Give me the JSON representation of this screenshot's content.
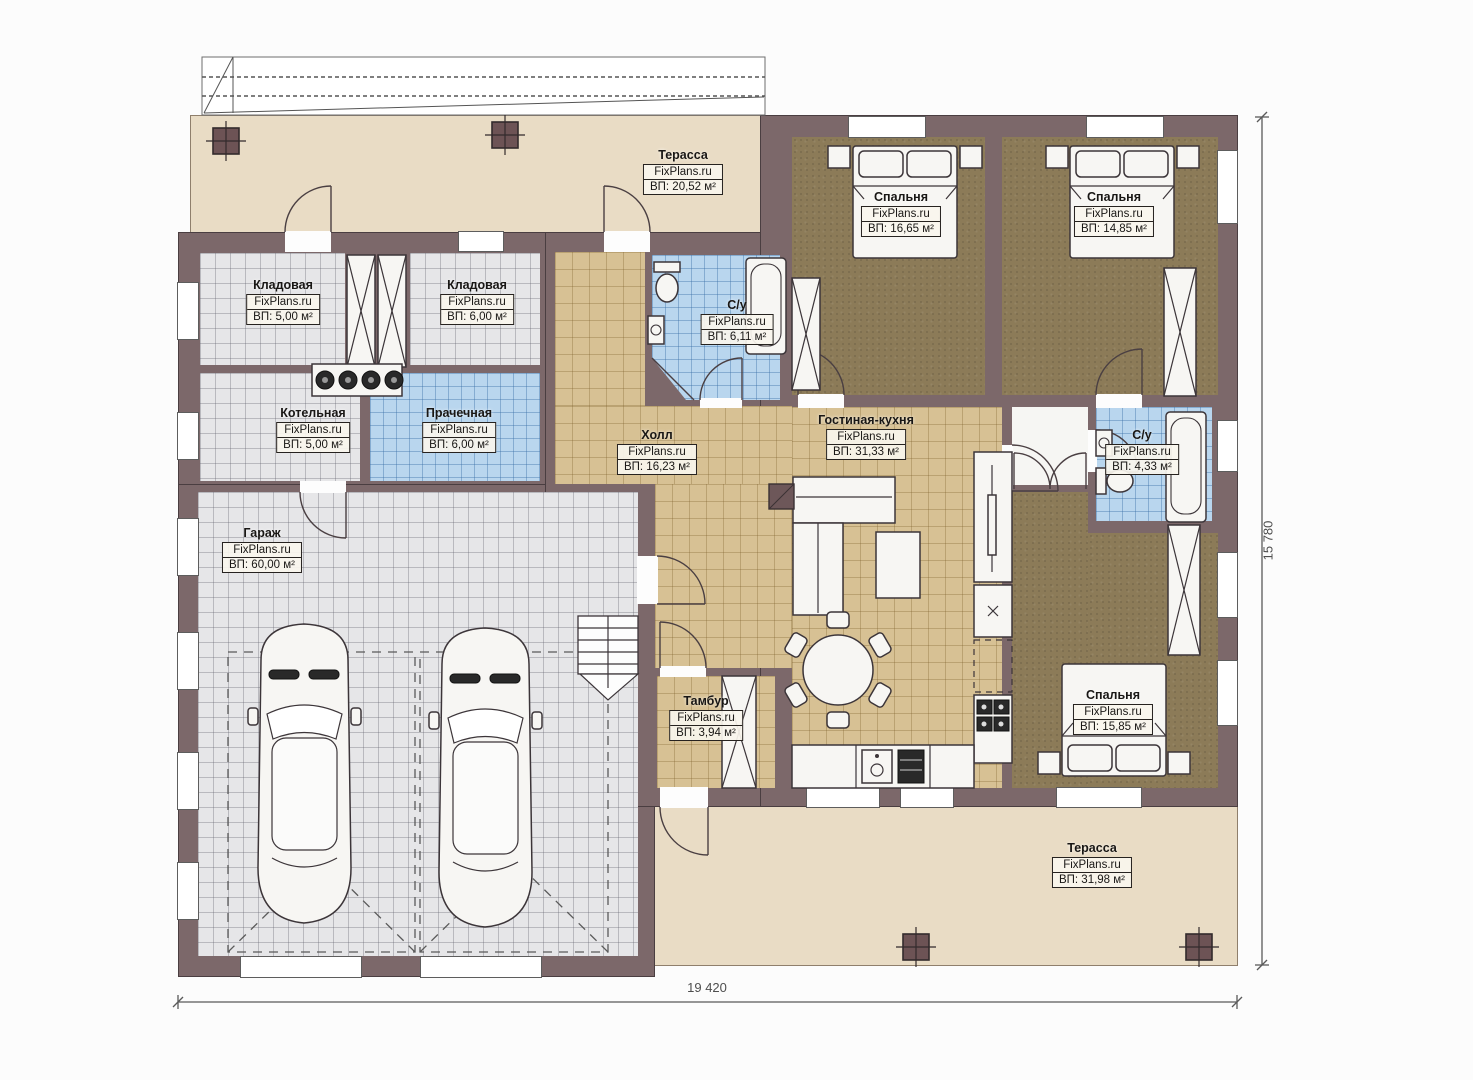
{
  "plan": {
    "brand": "FixPlans.ru",
    "rooms": [
      {
        "id": "terrace-top",
        "name": "Терасса",
        "area": "ВП: 20,52 м²"
      },
      {
        "id": "bedroom-1",
        "name": "Спальня",
        "area": "ВП: 16,65 м²"
      },
      {
        "id": "bedroom-2",
        "name": "Спальня",
        "area": "ВП: 14,85 м²"
      },
      {
        "id": "storage-1",
        "name": "Кладовая",
        "area": "ВП: 5,00 м²"
      },
      {
        "id": "storage-2",
        "name": "Кладовая",
        "area": "ВП: 6,00 м²"
      },
      {
        "id": "bathroom-top",
        "name": "С/у",
        "area": "ВП: 6,11 м²"
      },
      {
        "id": "boiler-room",
        "name": "Котельная",
        "area": "ВП: 5,00 м²"
      },
      {
        "id": "laundry",
        "name": "Прачечная",
        "area": "ВП: 6,00 м²"
      },
      {
        "id": "hall",
        "name": "Холл",
        "area": "ВП: 16,23 м²"
      },
      {
        "id": "living-kitchen",
        "name": "Гостиная-кухня",
        "area": "ВП: 31,33 м²"
      },
      {
        "id": "bathroom-right",
        "name": "С/у",
        "area": "ВП: 4,33 м²"
      },
      {
        "id": "garage",
        "name": "Гараж",
        "area": "ВП: 60,00 м²"
      },
      {
        "id": "vestibule",
        "name": "Тамбур",
        "area": "ВП: 3,94 м²"
      },
      {
        "id": "bedroom-3",
        "name": "Спальня",
        "area": "ВП: 15,85 м²"
      },
      {
        "id": "terrace-bottom",
        "name": "Терасса",
        "area": "ВП: 31,98 м²"
      }
    ],
    "dimensions": {
      "width": "19 420",
      "height": "15 780"
    },
    "colors": {
      "wall": "#7c686a",
      "floor_tan": "#d7c194",
      "floor_bedroom": "#8c7b58",
      "floor_blue": "#b9d6ee",
      "floor_gray": "#e6e6e8",
      "terrace": "#e9dcc5"
    }
  }
}
